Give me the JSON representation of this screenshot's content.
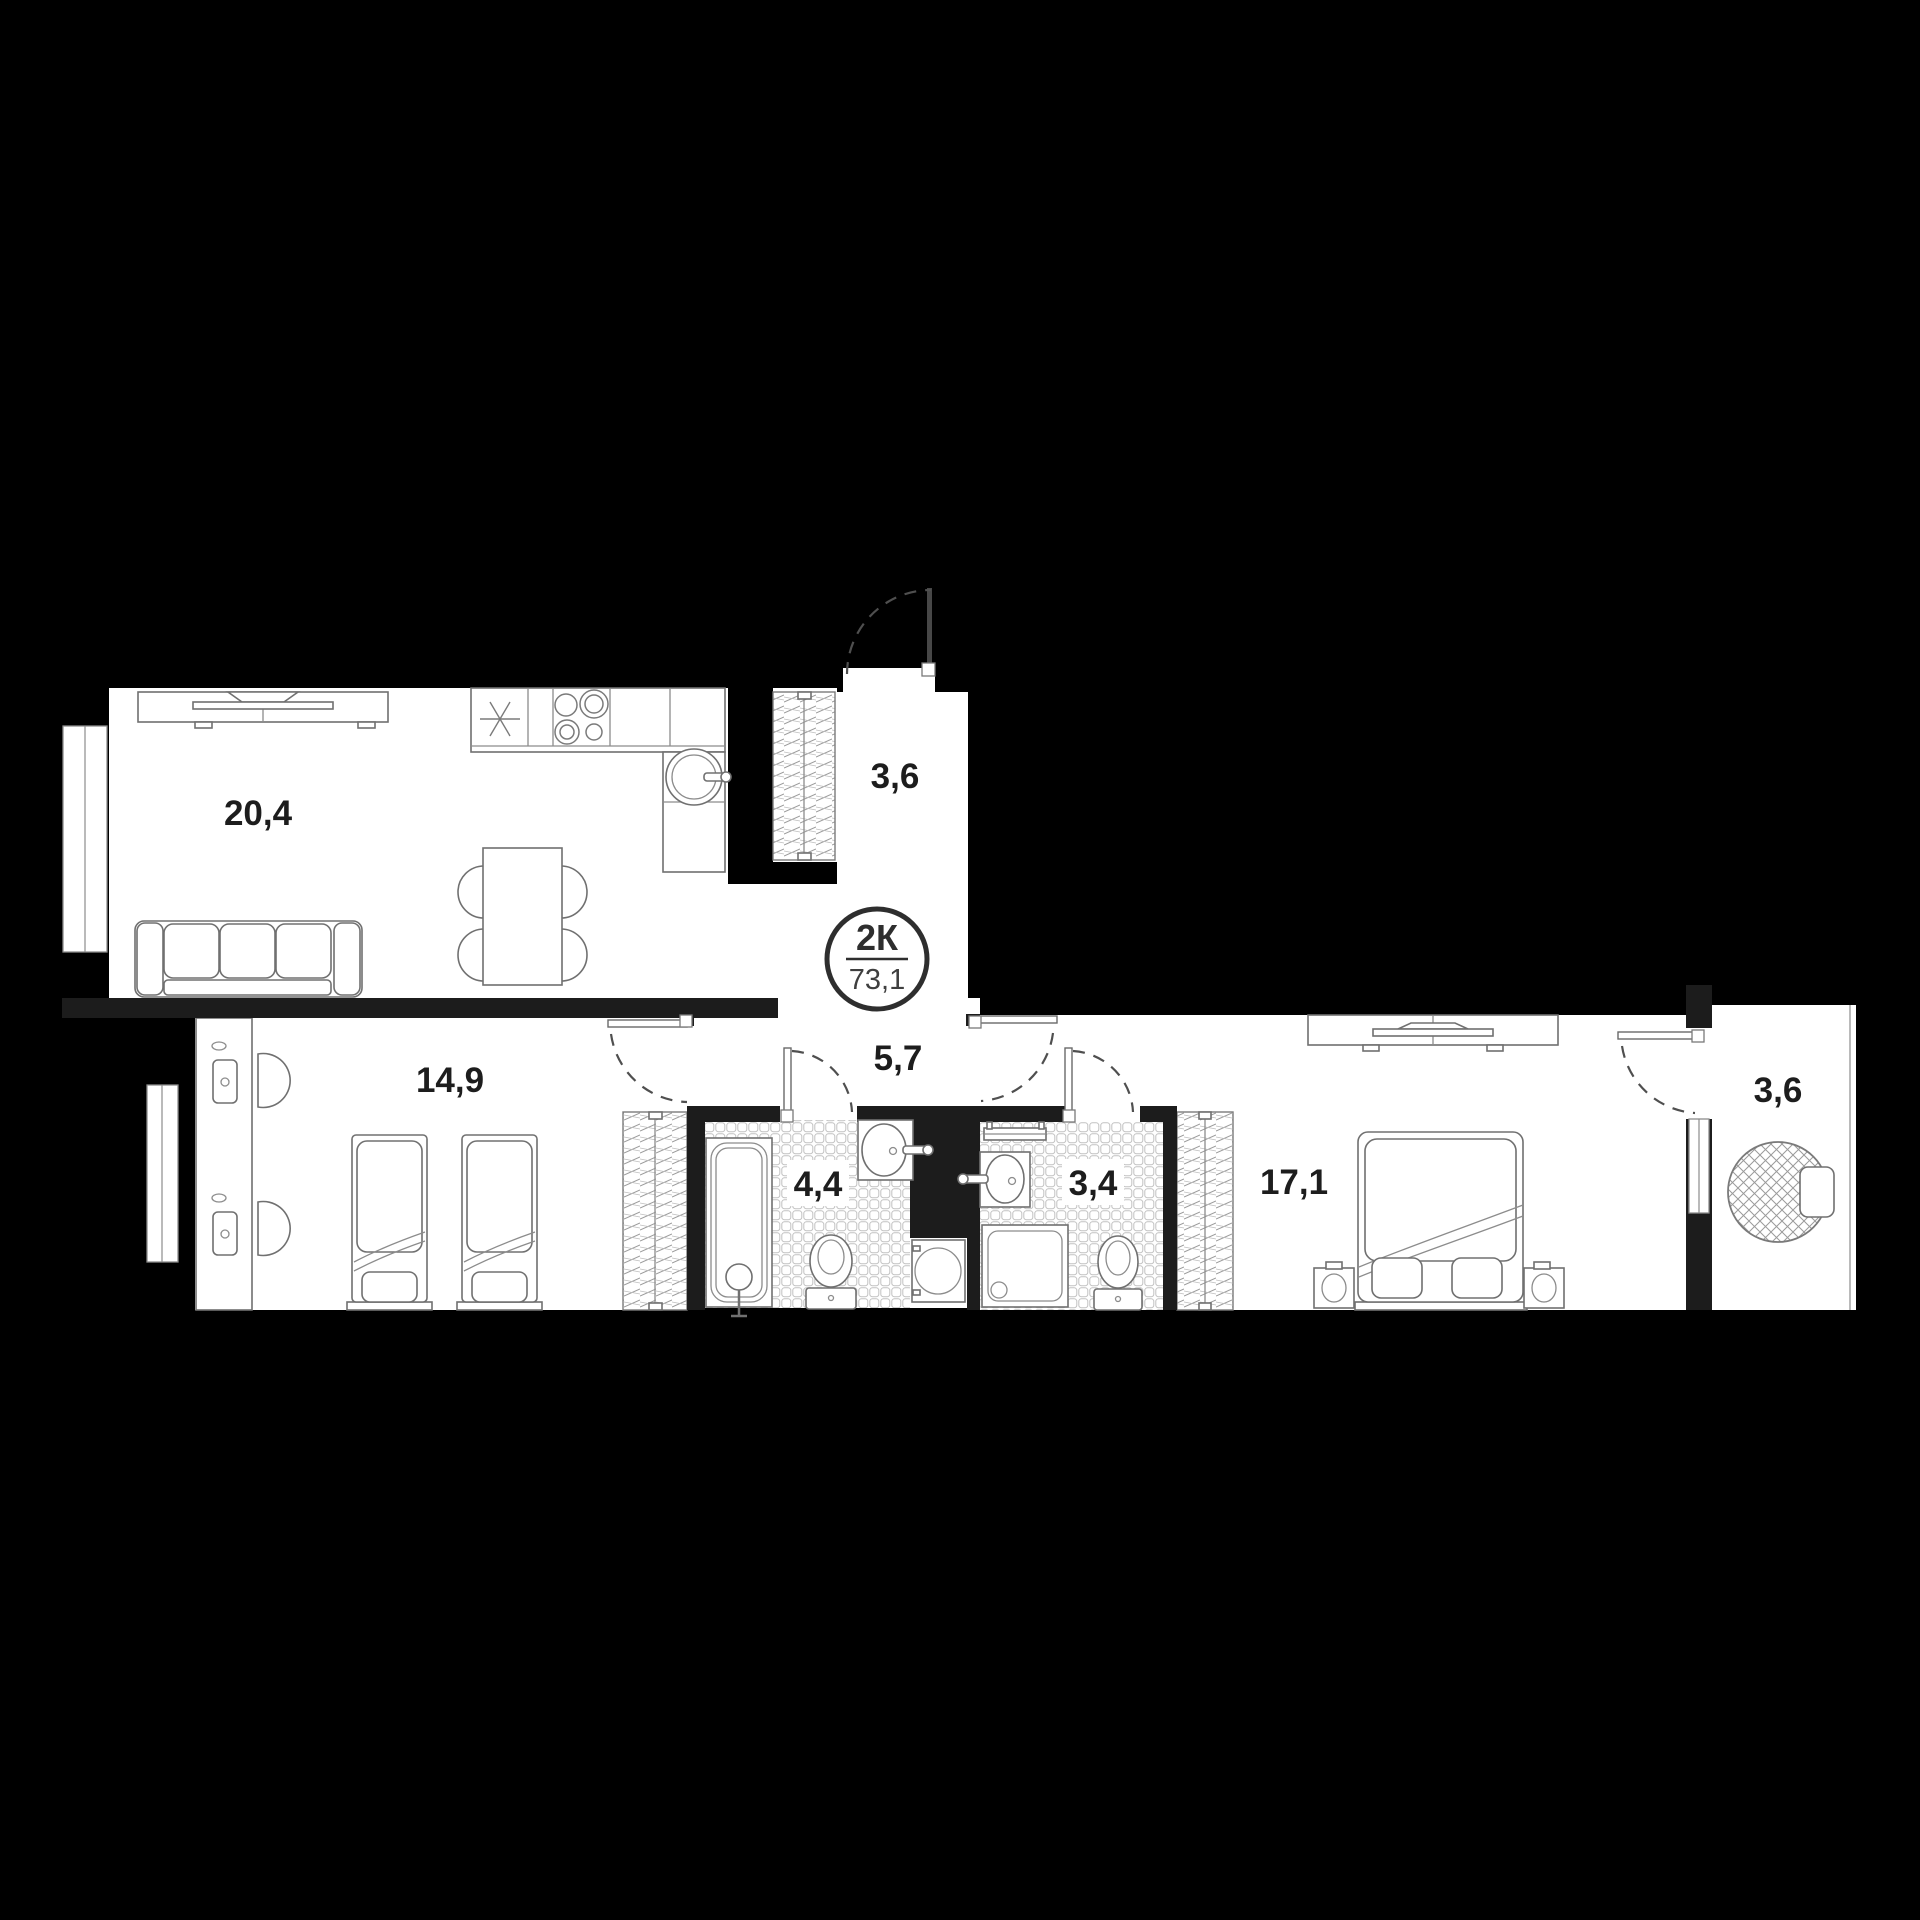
{
  "badge": {
    "rooms_label": "2К",
    "total_area": "73,1"
  },
  "rooms": {
    "living_kitchen": {
      "area_label": "20,4"
    },
    "entry_hall": {
      "area_label": "3,6"
    },
    "corridor": {
      "area_label": "5,7"
    },
    "children_bedroom": {
      "area_label": "14,9"
    },
    "bathroom": {
      "area_label": "4,4"
    },
    "shower_room": {
      "area_label": "3,4"
    },
    "master_bedroom": {
      "area_label": "17,1"
    },
    "loggia": {
      "area_label": "3,6"
    }
  },
  "colors": {
    "background": "#000000",
    "wall": "#1c1c1c",
    "floor": "#ffffff",
    "furniture_line": "#707070",
    "label_text": "#1d1d1d",
    "badge_ring": "#2e2e2e"
  }
}
